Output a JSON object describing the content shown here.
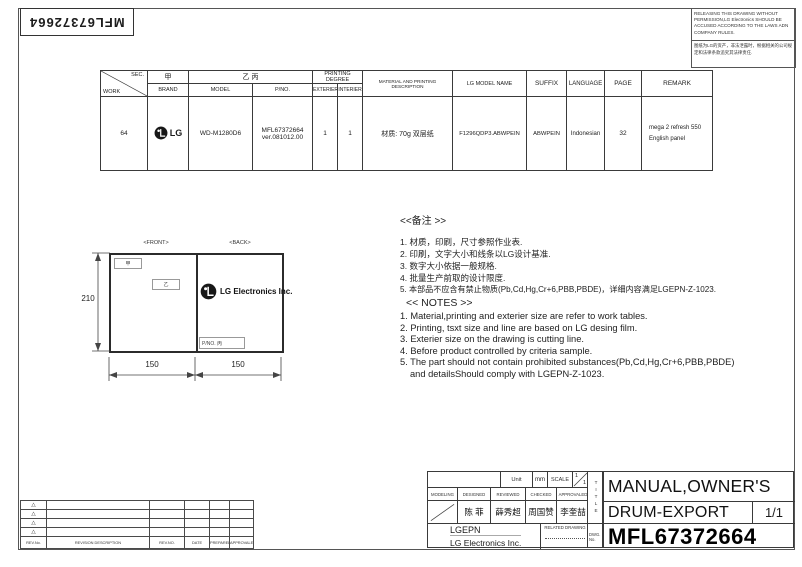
{
  "stamp": {
    "text": "MFL67372664"
  },
  "warning_box": {
    "english": "RELEASING THIS DRAWING WITHOUT PERMISSION,LG Electronics SHOULD BE ACCUSED ACCORDING TO THE LAWS ADN COMPANY RULES.",
    "chinese": "图纸为LG的资产，非法泄露时，根据相关的公司规定和法律条款追究其法律责任."
  },
  "spec_table": {
    "header": {
      "sec": "SEC.",
      "work": "WORK",
      "jia": "甲",
      "brand": "BRAND",
      "yi_bing": "乙 丙",
      "model": "MODEL",
      "pno": "P/NO.",
      "printing_degree": "PRINTING DEGREE",
      "exterier": "EXTERIER",
      "interier": "INTERIER",
      "material": "MATERIAL AND PRINTING DESCRIPTION",
      "lg_model_name": "LG MODEL NAME",
      "suffix": "SUFFIX",
      "language": "LANGUAGE",
      "page": "PAGE",
      "remark": "REMARK"
    },
    "row": {
      "work": "64",
      "brand_word": "LG",
      "model": "WD-M1280D6",
      "pno_line1": "MFL67372664",
      "pno_line2": "ver.081012.00",
      "exterier": "1",
      "interier": "1",
      "material": "材质: 70g 双层纸",
      "lg_model_name": "F1296QDP3.ABWPEIN",
      "suffix": "ABWPEIN",
      "language": "Indonesian",
      "page": "32",
      "remark_line1": "mega 2 refresh 550",
      "remark_line2": "English  panel"
    }
  },
  "drawing": {
    "front_label": "<FRONT>",
    "back_label": "<BACK>",
    "jia_label": "甲",
    "yi_label": "乙",
    "pno_label": "P/NO. 丙",
    "logo_text": "LG Electronics Inc.",
    "dim_height": "210",
    "dim_width_front": "150",
    "dim_width_back": "150"
  },
  "notes_cn": {
    "title": "<<备注 >>",
    "items": [
      "1.  材质，印刷，尺寸参照作业表.",
      "2.  印刷，文字大小和线条以LG设计基准.",
      "3.  数字大小依据一般规格.",
      "4.  批量生产前取的设计限度.",
      "5.  本部品不应含有禁止物质(Pb,Cd,Hg,Cr+6,PBB,PBDE)，详细内容满足LGEPN-Z-1023."
    ]
  },
  "notes_en": {
    "title": "<< NOTES >>",
    "items": [
      "1. Material,printing and exterier size are refer to work tables.",
      "2. Printing, tsxt  size and line are based on LG desing film.",
      "3. Exterier size on the drawing is cutting line.",
      "4. Before product controlled by criteria sample.",
      "5. The part should not contain prohibited substances(Pb,Cd,Hg,Cr+6,PBB,PBDE)"
    ],
    "item5_cont": "and detailsShould comply with LGEPN-Z-1023."
  },
  "revision_table": {
    "marker_glyph": "△",
    "headers": [
      "REV.No.",
      "REVISION DESCRIPTION",
      "REV.NO.",
      "DATE",
      "PREPARED",
      "APPROVALED"
    ]
  },
  "title_block": {
    "unit_label": "Unit",
    "unit_value": "mm",
    "scale_label": "SCALE",
    "scale_value_top": "1",
    "scale_value_bottom": "1",
    "col_headers": [
      "MODELING",
      "DESIGNED",
      "REVIEWED",
      "CHECKED",
      "APPROVALED"
    ],
    "designed_name": "陈 菲",
    "reviewed_name": "薛秀超",
    "checked_name": "周国赞",
    "approved_name": "李奎喆",
    "company_short": "LGEPN",
    "company_full": "LG Electronics Inc.",
    "related_drawing_label": "RELATED DRAWING",
    "title_label_vertical": "TITLE",
    "dwg_label": "DWG. No.",
    "title_line1": "MANUAL,OWNER'S",
    "title_line2": "DRUM-EXPORT",
    "sheet": "1/1",
    "dwg_no": "MFL67372664"
  }
}
